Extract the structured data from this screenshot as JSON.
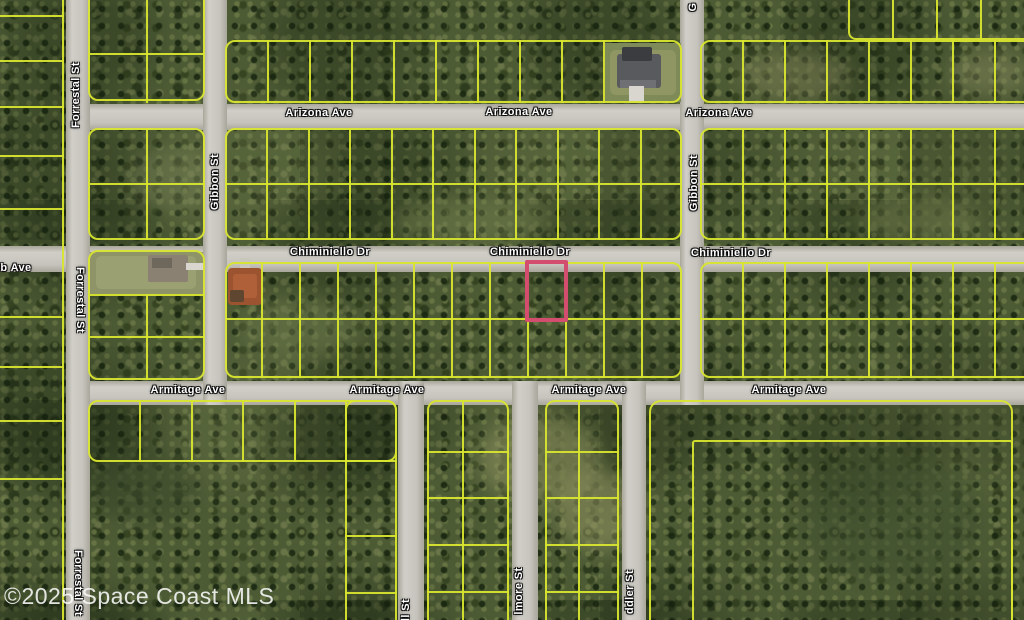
{
  "map": {
    "width": 1024,
    "height": 620,
    "watermark": "©2025 Space Coast MLS",
    "colors": {
      "vegetation_base": "#4d5b35",
      "parcel_line": "#d8e52f",
      "road_fill": "#c8c6bf",
      "highlight_outline": "#d34d6e",
      "label_text": "#ffffff"
    },
    "highlight_parcel": {
      "x": 525,
      "y": 260,
      "w": 43,
      "h": 62
    },
    "street_labels": [
      {
        "text": "Arizona Ave",
        "x": 319,
        "y": 113,
        "rot": 0
      },
      {
        "text": "Arizona Ave",
        "x": 519,
        "y": 112,
        "rot": 0
      },
      {
        "text": "Arizona Ave",
        "x": 719,
        "y": 113,
        "rot": 0
      },
      {
        "text": "Chiminiello Dr",
        "x": 330,
        "y": 252,
        "rot": 0
      },
      {
        "text": "Chiminiello Dr",
        "x": 530,
        "y": 252,
        "rot": 0
      },
      {
        "text": "Chiminiello Dr",
        "x": 731,
        "y": 253,
        "rot": 0
      },
      {
        "text": "Armitage Ave",
        "x": 188,
        "y": 390,
        "rot": 0
      },
      {
        "text": "Armitage Ave",
        "x": 387,
        "y": 390,
        "rot": 0
      },
      {
        "text": "Armitage Ave",
        "x": 589,
        "y": 390,
        "rot": 0
      },
      {
        "text": "Armitage Ave",
        "x": 789,
        "y": 390,
        "rot": 0
      },
      {
        "text": "b Ave",
        "x": 16,
        "y": 268,
        "rot": 0
      },
      {
        "text": "Forrestal St",
        "x": 76,
        "y": 95,
        "rot": -90
      },
      {
        "text": "Forrestal St",
        "x": 80,
        "y": 300,
        "rot": 90
      },
      {
        "text": "Forrestal St",
        "x": 78,
        "y": 583,
        "rot": 90
      },
      {
        "text": "Gibbon St",
        "x": 215,
        "y": 182,
        "rot": -90
      },
      {
        "text": "Gibbon St",
        "x": 694,
        "y": 183,
        "rot": -90
      },
      {
        "text": "G",
        "x": 693,
        "y": 7,
        "rot": -90
      },
      {
        "text": "ll St",
        "x": 406,
        "y": 610,
        "rot": -90
      },
      {
        "text": "lmore St",
        "x": 519,
        "y": 591,
        "rot": -90
      },
      {
        "text": "ddler St",
        "x": 630,
        "y": 592,
        "rot": -90
      }
    ],
    "roads": [
      {
        "name": "Arizona Ave",
        "dir": "h",
        "x": 66,
        "y": 104,
        "w": 958,
        "h": 26
      },
      {
        "name": "Chiminiello Dr",
        "dir": "h",
        "x": 0,
        "y": 246,
        "w": 1024,
        "h": 26
      },
      {
        "name": "Armitage Ave",
        "dir": "h",
        "x": 66,
        "y": 381,
        "w": 958,
        "h": 24
      },
      {
        "name": "Forrestal St",
        "dir": "v",
        "x": 66,
        "y": 0,
        "w": 24,
        "h": 620
      },
      {
        "name": "Gibbon St",
        "dir": "v",
        "x": 203,
        "y": 0,
        "w": 24,
        "h": 405
      },
      {
        "name": "Gibbon St",
        "dir": "v",
        "x": 680,
        "y": 0,
        "w": 24,
        "h": 405
      },
      {
        "name": "ll St",
        "dir": "v",
        "x": 398,
        "y": 381,
        "w": 26,
        "h": 239
      },
      {
        "name": "lmore St",
        "dir": "v",
        "x": 512,
        "y": 381,
        "w": 26,
        "h": 239
      },
      {
        "name": "ddler St",
        "dir": "v",
        "x": 622,
        "y": 381,
        "w": 24,
        "h": 239
      }
    ],
    "parcel_boxes": [
      {
        "x": 88,
        "y": -12,
        "w": 117,
        "h": 113,
        "r": 10
      },
      {
        "x": 225,
        "y": 40,
        "w": 457,
        "h": 63,
        "r": 10
      },
      {
        "x": 700,
        "y": 40,
        "w": 336,
        "h": 63,
        "r": 10
      },
      {
        "x": 848,
        "y": -12,
        "w": 188,
        "h": 52,
        "r": 8
      },
      {
        "x": 88,
        "y": 128,
        "w": 117,
        "h": 112,
        "r": 10
      },
      {
        "x": 225,
        "y": 128,
        "w": 457,
        "h": 112,
        "r": 10
      },
      {
        "x": 700,
        "y": 128,
        "w": 336,
        "h": 112,
        "r": 10
      },
      {
        "x": 88,
        "y": 250,
        "w": 117,
        "h": 130,
        "r": 10
      },
      {
        "x": 225,
        "y": 262,
        "w": 457,
        "h": 116,
        "r": 10
      },
      {
        "x": 700,
        "y": 262,
        "w": 336,
        "h": 116,
        "r": 10
      },
      {
        "x": 88,
        "y": 400,
        "w": 309,
        "h": 62,
        "r": 10
      },
      {
        "x": 345,
        "y": 400,
        "w": 52,
        "h": 232,
        "r": 10
      },
      {
        "x": 427,
        "y": 400,
        "w": 82,
        "h": 232,
        "r": 10
      },
      {
        "x": 545,
        "y": 400,
        "w": 74,
        "h": 232,
        "r": 10
      },
      {
        "x": 649,
        "y": 400,
        "w": 364,
        "h": 232,
        "r": 12
      },
      {
        "x": 692,
        "y": 440,
        "w": 321,
        "h": 192,
        "r": 3
      }
    ],
    "parcel_lines": [
      {
        "x": 62,
        "y": 0,
        "w": 2,
        "h": 620
      },
      {
        "x": 0,
        "y": 15,
        "w": 64,
        "h": 2
      },
      {
        "x": 0,
        "y": 60,
        "w": 64,
        "h": 2
      },
      {
        "x": 0,
        "y": 106,
        "w": 64,
        "h": 2
      },
      {
        "x": 0,
        "y": 155,
        "w": 64,
        "h": 2
      },
      {
        "x": 0,
        "y": 208,
        "w": 64,
        "h": 2
      },
      {
        "x": 0,
        "y": 316,
        "w": 64,
        "h": 2
      },
      {
        "x": 0,
        "y": 366,
        "w": 64,
        "h": 2
      },
      {
        "x": 0,
        "y": 420,
        "w": 64,
        "h": 2
      },
      {
        "x": 0,
        "y": 478,
        "w": 64,
        "h": 2
      },
      {
        "x": 88,
        "y": 53,
        "w": 117,
        "h": 2
      },
      {
        "x": 146,
        "y": 0,
        "w": 2,
        "h": 103
      },
      {
        "x": 267,
        "y": 40,
        "w": 2,
        "h": 63,
        "dir": "x",
        "step": 42,
        "count": 9
      },
      {
        "x": 742,
        "y": 40,
        "w": 2,
        "h": 63,
        "dir": "x",
        "step": 42,
        "count": 7
      },
      {
        "x": 892,
        "y": 0,
        "w": 2,
        "h": 40,
        "dir": "x",
        "step": 44,
        "count": 3
      },
      {
        "x": 88,
        "y": 183,
        "w": 117,
        "h": 2
      },
      {
        "x": 146,
        "y": 128,
        "w": 2,
        "h": 112
      },
      {
        "x": 225,
        "y": 183,
        "w": 457,
        "h": 2
      },
      {
        "x": 266,
        "y": 128,
        "w": 2,
        "h": 112,
        "dir": "x",
        "step": 41.5,
        "count": 10
      },
      {
        "x": 700,
        "y": 183,
        "w": 336,
        "h": 2
      },
      {
        "x": 742,
        "y": 128,
        "w": 2,
        "h": 112,
        "dir": "x",
        "step": 42,
        "count": 7
      },
      {
        "x": 88,
        "y": 294,
        "w": 117,
        "h": 2
      },
      {
        "x": 88,
        "y": 336,
        "w": 117,
        "h": 2
      },
      {
        "x": 146,
        "y": 294,
        "w": 2,
        "h": 86
      },
      {
        "x": 225,
        "y": 318,
        "w": 457,
        "h": 2
      },
      {
        "x": 261,
        "y": 262,
        "w": 2,
        "h": 116,
        "dir": "x",
        "step": 38,
        "count": 11
      },
      {
        "x": 700,
        "y": 318,
        "w": 336,
        "h": 2
      },
      {
        "x": 742,
        "y": 262,
        "w": 2,
        "h": 116,
        "dir": "x",
        "step": 42,
        "count": 7
      },
      {
        "x": 139,
        "y": 400,
        "w": 2,
        "h": 62,
        "dir": "x",
        "step": 51.5,
        "count": 5
      },
      {
        "x": 345,
        "y": 460,
        "w": 52,
        "h": 2
      },
      {
        "x": 345,
        "y": 535,
        "w": 52,
        "h": 2
      },
      {
        "x": 345,
        "y": 592,
        "w": 52,
        "h": 2
      },
      {
        "x": 462,
        "y": 400,
        "w": 2,
        "h": 220
      },
      {
        "x": 427,
        "y": 451,
        "w": 82,
        "h": 2
      },
      {
        "x": 427,
        "y": 497,
        "w": 82,
        "h": 2
      },
      {
        "x": 427,
        "y": 544,
        "w": 82,
        "h": 2
      },
      {
        "x": 427,
        "y": 591,
        "w": 82,
        "h": 2
      },
      {
        "x": 578,
        "y": 400,
        "w": 2,
        "h": 220
      },
      {
        "x": 545,
        "y": 451,
        "w": 74,
        "h": 2
      },
      {
        "x": 545,
        "y": 497,
        "w": 74,
        "h": 2
      },
      {
        "x": 545,
        "y": 544,
        "w": 74,
        "h": 2
      },
      {
        "x": 545,
        "y": 591,
        "w": 74,
        "h": 2
      }
    ],
    "terrain_patches": [
      {
        "x": 480,
        "y": 415,
        "w": 120,
        "h": 90,
        "c": "#8f935f",
        "o": 0.55
      },
      {
        "x": 555,
        "y": 470,
        "w": 90,
        "h": 80,
        "c": "#999a66",
        "o": 0.5
      },
      {
        "x": 740,
        "y": 52,
        "w": 110,
        "h": 48,
        "c": "#7d7f55",
        "o": 0.5
      },
      {
        "x": 950,
        "y": 52,
        "w": 80,
        "h": 44,
        "c": "#85875c",
        "o": 0.45
      },
      {
        "x": 240,
        "y": 298,
        "w": 120,
        "h": 62,
        "c": "#6d7a4c",
        "o": 0.5
      },
      {
        "x": 390,
        "y": 198,
        "w": 160,
        "h": 46,
        "c": "#76814f",
        "o": 0.45
      },
      {
        "x": 90,
        "y": 452,
        "w": 110,
        "h": 72,
        "c": "#3c4a2c",
        "o": 0.6
      },
      {
        "x": 800,
        "y": 458,
        "w": 180,
        "h": 122,
        "c": "#3f4f2e",
        "o": 0.55
      },
      {
        "x": 130,
        "y": 148,
        "w": 90,
        "h": 62,
        "c": "#7c855a",
        "o": 0.4
      },
      {
        "x": 860,
        "y": 198,
        "w": 120,
        "h": 46,
        "c": "#77814f",
        "o": 0.45
      }
    ],
    "houses": [
      {
        "name": "gray-roof-house",
        "parts": [
          {
            "x": 605,
            "y": 43,
            "w": 76,
            "h": 59,
            "c": "#7e8a58"
          },
          {
            "x": 610,
            "y": 50,
            "w": 66,
            "h": 45,
            "c": "#8f9663",
            "r": 6
          },
          {
            "x": 617,
            "y": 54,
            "w": 44,
            "h": 34,
            "c": "#585a5e",
            "r": 3
          },
          {
            "x": 622,
            "y": 47,
            "w": 30,
            "h": 14,
            "c": "#3a3c40",
            "r": 2
          },
          {
            "x": 620,
            "y": 80,
            "w": 36,
            "h": 8,
            "c": "#6e7074"
          },
          {
            "x": 629,
            "y": 86,
            "w": 15,
            "h": 17,
            "c": "#d8d6cf"
          }
        ]
      },
      {
        "name": "tan-roof-house",
        "parts": [
          {
            "x": 90,
            "y": 252,
            "w": 113,
            "h": 42,
            "c": "#8e9468"
          },
          {
            "x": 96,
            "y": 256,
            "w": 100,
            "h": 33,
            "c": "#9aa071",
            "r": 5
          },
          {
            "x": 148,
            "y": 255,
            "w": 40,
            "h": 27,
            "c": "#8b8172",
            "r": 2
          },
          {
            "x": 152,
            "y": 258,
            "w": 20,
            "h": 10,
            "c": "#6e675c"
          },
          {
            "x": 186,
            "y": 263,
            "w": 18,
            "h": 7,
            "c": "#d8d6cf"
          }
        ]
      },
      {
        "name": "orange-roof-house",
        "parts": [
          {
            "x": 240,
            "y": 258,
            "w": 10,
            "h": 10,
            "c": "#c9c6bb"
          },
          {
            "x": 228,
            "y": 268,
            "w": 34,
            "h": 37,
            "c": "#9c5430",
            "r": 4
          },
          {
            "x": 233,
            "y": 274,
            "w": 24,
            "h": 24,
            "c": "#b06038",
            "r": 3
          },
          {
            "x": 230,
            "y": 290,
            "w": 14,
            "h": 12,
            "c": "#5f4630",
            "r": 2
          }
        ]
      }
    ]
  }
}
